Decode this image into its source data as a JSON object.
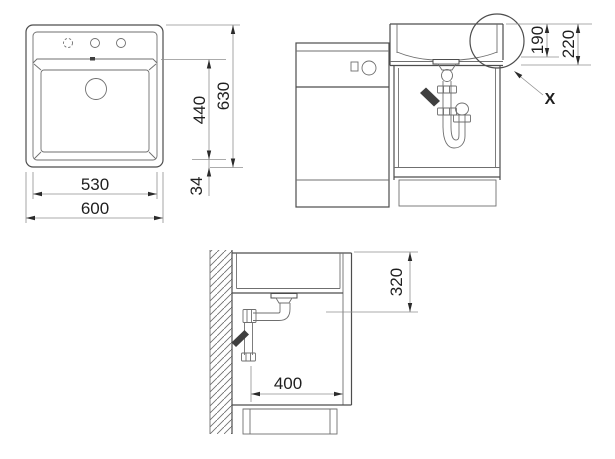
{
  "views": {
    "front": {
      "dims": {
        "inner_width": "530",
        "outer_width": "600",
        "bowl_height": "440",
        "total_height": "630",
        "base_offset": "34"
      }
    },
    "side": {
      "dims": {
        "bowl_depth": "190",
        "total_depth": "220"
      },
      "detail_marker": "X"
    },
    "section": {
      "dims": {
        "outlet_height": "320",
        "clearance_depth": "400"
      }
    }
  },
  "colors": {
    "background": "#ffffff",
    "outline": "#4d4d4d",
    "dimension_line": "#8f8f8f",
    "text": "#1f1f1f"
  }
}
